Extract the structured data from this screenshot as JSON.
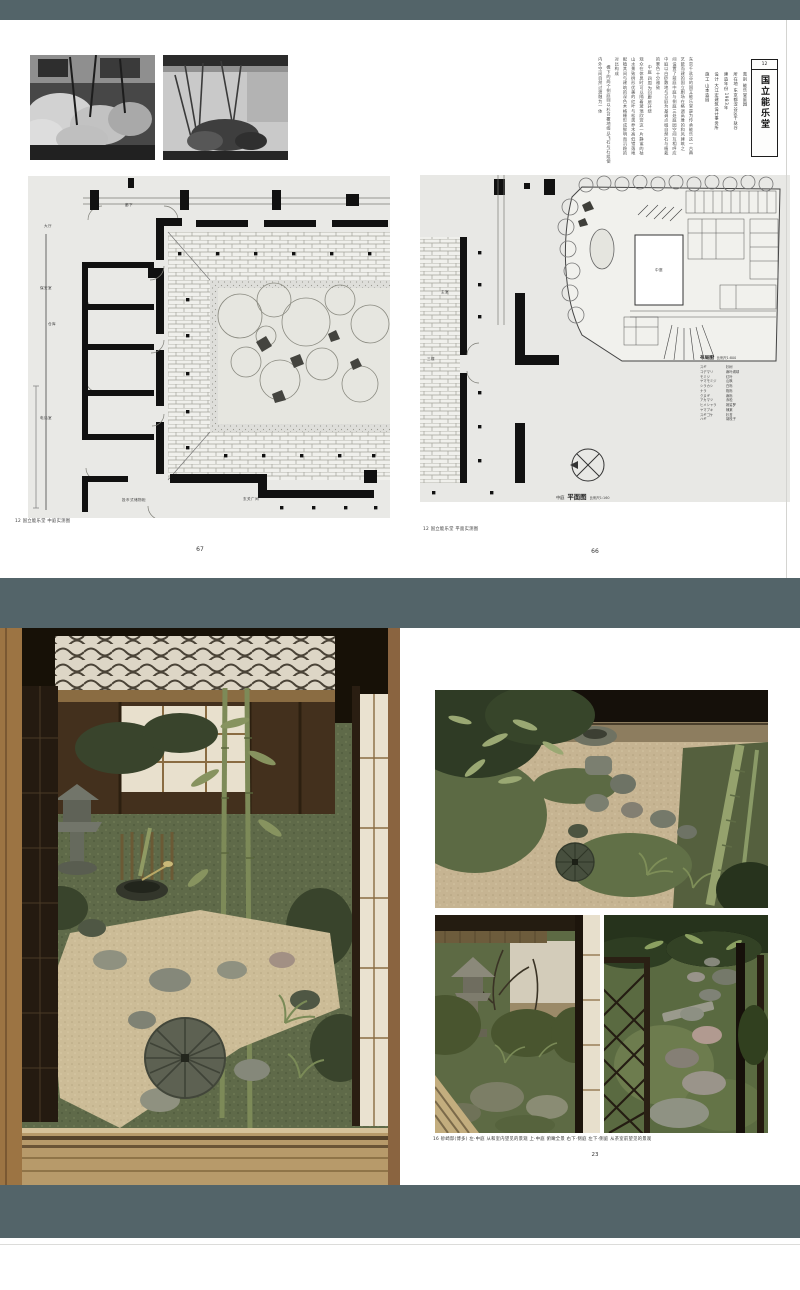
{
  "colors": {
    "band": "#536469",
    "plan_paper": "#e9e9e6",
    "page": "#ffffff"
  },
  "top_spread": {
    "left_page": {
      "photo_captions": [
        "中庭 北侧景观",
        "中庭 中央石组"
      ],
      "plan_labels": {
        "corridor": "廊下",
        "hall": "大厅",
        "security": "保安室",
        "storage": "仓库",
        "phone": "电话室",
        "lockers": "投币式储物柜",
        "foyer": "玄关广间"
      },
      "caption": "12 国立能乐堂 中庭实测图",
      "page_number": "67"
    },
    "right_page": {
      "body_columns": [
        "东京千驮谷的国立能乐堂是为传承能乐这一古典",
        "艺能而建的国立剧场在格调高雅的和风建筑之",
        "间设置了前庭中庭与侧庭三处庭园空间互相呼应",
        "中庭以白砂敷地与苔庭为基调点缀自然石与植栽",
        "的景色十分雅致",
        "中庭 四周为回廊所环绕",
        "观众在休息时可以隔着玻璃欣赏这一片静谧的枯",
        "山水景致树形优美的红叶与松类乔木高低错落地",
        "配植其间与建筑的深色木格栅形成鲜明而沉稳的",
        "对比构成",
        "檐下的两个侧庭则以杉苔覆地缀以飞石与石组使",
        "内外空间自然过渡融为一体"
      ],
      "credits": [
        "类别 能乐堂庭园",
        "所在地 东京都涩谷区千驮谷",
        "建造年份 1983年",
        "设计 大江宏建筑设计事务所",
        "施工 山本造园"
      ],
      "title_box": {
        "number": "12",
        "title": "国立能乐堂"
      },
      "fragment_labels": {
        "room": "主室",
        "floor": "三楼"
      },
      "site_plan_label": "中庭",
      "legend_title": "布局图",
      "legend_scale": "比例尺1:800",
      "plants": [
        [
          "スギ",
          "杉树"
        ],
        [
          "コデマリ",
          "麻叶绣球"
        ],
        [
          "モミジ",
          "红叶"
        ],
        [
          "ヤマモミジ",
          "山枫"
        ],
        [
          "シラカシ",
          "白栎"
        ],
        [
          "ナラ",
          "枹栎"
        ],
        [
          "クヌギ",
          "麻栎"
        ],
        [
          "アカマツ",
          "赤松"
        ],
        [
          "ヒメシャラ",
          "姬娑罗"
        ],
        [
          "ヤマブキ",
          "棣棠"
        ],
        [
          "スギゴケ",
          "杉苔"
        ],
        [
          "ハギ",
          "胡枝子"
        ]
      ],
      "plan_title": {
        "prefix": "中庭",
        "name": "平面图",
        "scale": "比例尺1:160"
      },
      "caption": "12 国立能乐堂 平面实测图",
      "page_number": "66"
    }
  },
  "bottom_spread": {
    "caption": "16 砂崎邸(博多) 左·中庭 从和室内望见的景观 上·中庭 俯瞰全景 右下·侧庭 左下·侧庭 从茶室前望见的景观",
    "page_number": "23"
  }
}
